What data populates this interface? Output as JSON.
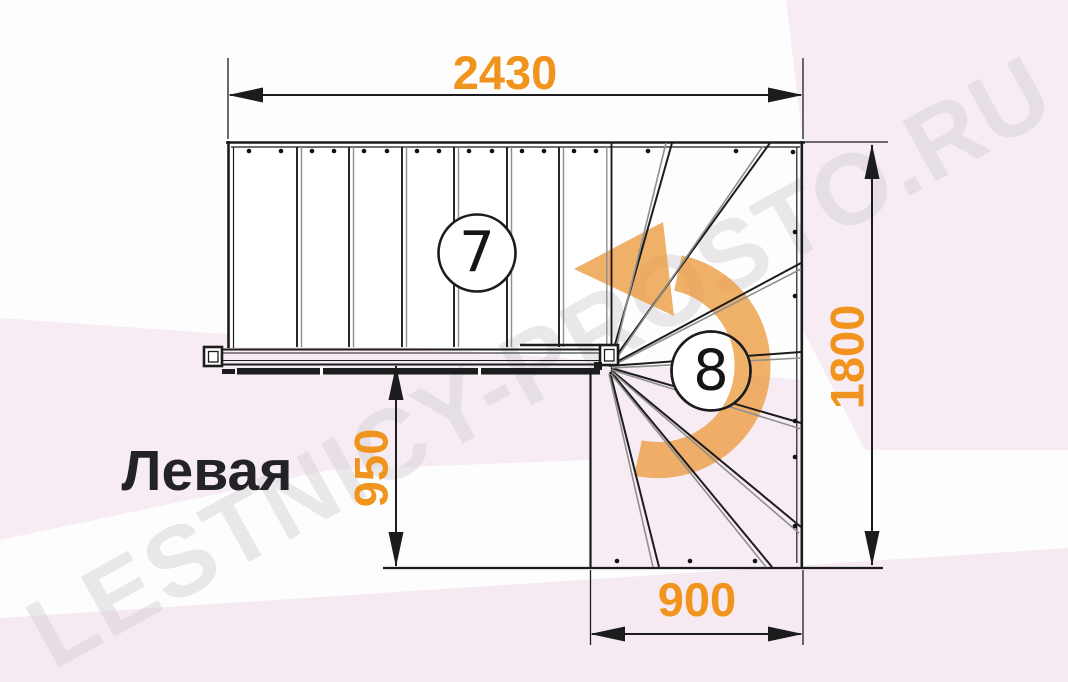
{
  "watermark": {
    "text": "LESTNICY-PROSTO.RU"
  },
  "orientation": {
    "label": "Левая"
  },
  "dimensions": {
    "top_width": {
      "value": "2430"
    },
    "right_height": {
      "value": "1800"
    },
    "mid_height": {
      "value": "950"
    },
    "bottom_width": {
      "value": "900"
    }
  },
  "steps": {
    "straight_count": "7",
    "winder_count": "8"
  },
  "icons": {
    "turn_arrow": "counter-clockwise-turn-arrow"
  },
  "colors": {
    "dimension_text": "#F0941D",
    "turn_arrow": "#EC9D43",
    "line": "#1C1C1E",
    "background_tint": "#F7ECF4",
    "watermark_gray": "#D7D2D7"
  }
}
